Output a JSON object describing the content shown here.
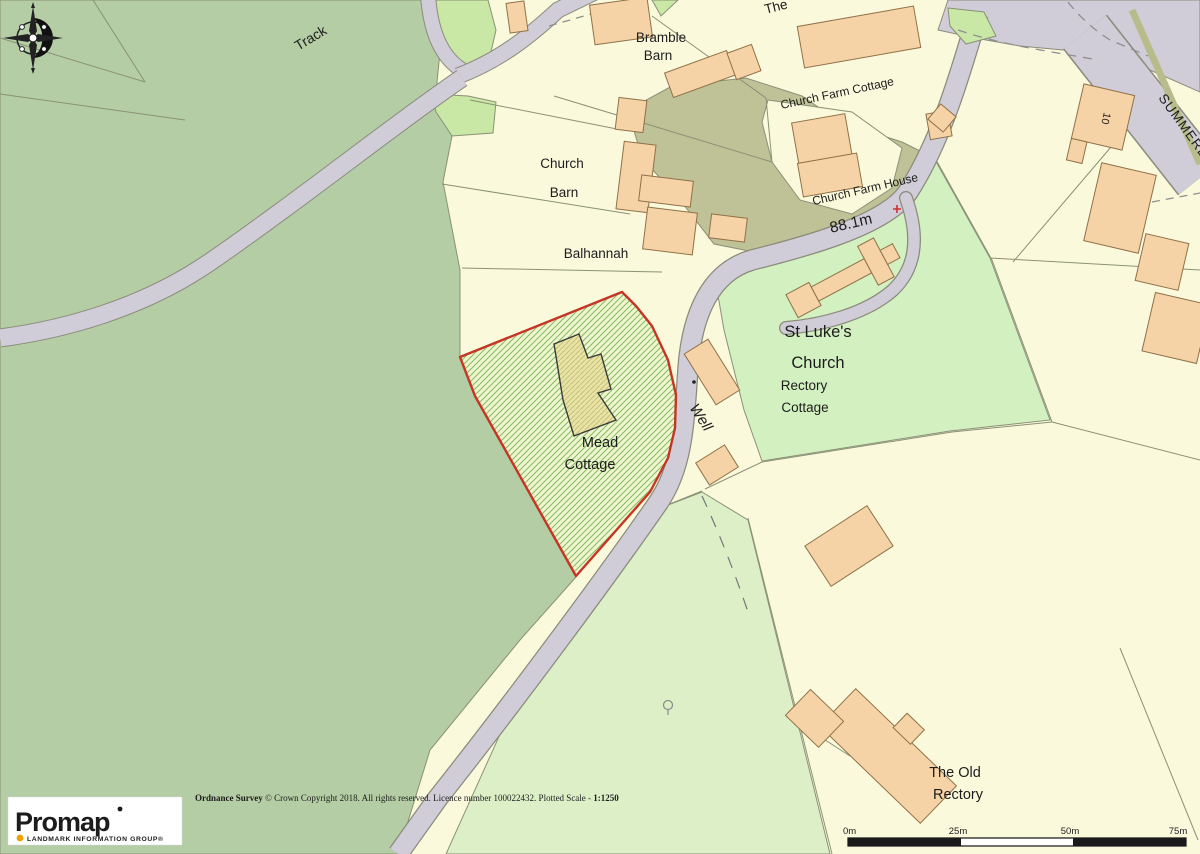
{
  "map": {
    "labels": {
      "track": "Track",
      "bramble_barn_line1": "Bramble",
      "bramble_barn_line2": "Barn",
      "the_partial": "The",
      "church_farm_cottage": "Church Farm Cottage",
      "church_barn_line1": "Church",
      "church_barn_line2": "Barn",
      "balhannah": "Balhannah",
      "church_farm_house": "Church Farm House",
      "spot_height": "88.1m",
      "st_lukes_line1": "St Luke's",
      "st_lukes_line2": "Church",
      "rectory_cottage_line1": "Rectory",
      "rectory_cottage_line2": "Cottage",
      "mead_cottage_line1": "Mead",
      "mead_cottage_line2": "Cottage",
      "well": "Well",
      "street": "SUMMERLE",
      "house_number": "10",
      "old_rectory_line1": "The Old",
      "old_rectory_line2": "Rectory"
    },
    "colors": {
      "field_green": "#b4cda4",
      "light_field_green": "#dcefc7",
      "churchyard_green": "#d3f0c0",
      "bright_verge_green": "#c9e7a5",
      "scrub_khaki": "#bfc196",
      "parcel_cream": "#fbf9dc",
      "road_grey": "#d0cdd8",
      "verge_khaki": "#b8bc8a",
      "building_peach": "#f6d3a7",
      "plot_fill": "#eef5cf",
      "plot_hatch_green": "#85bb63",
      "plot_outline_red": "#c63424",
      "well_text_blue": "#2e9bd6",
      "spot_cross_red": "#d03030",
      "logo_bullet_orange": "#f0a000"
    }
  },
  "attribution": {
    "prefix": "Ordnance Survey",
    "body": " © Crown Copyright 2018. All rights reserved. Licence number 100022432. Plotted Scale - ",
    "scale": "1:1250"
  },
  "logo": {
    "name": "Promap",
    "tagline": "LANDMARK INFORMATION GROUP®"
  },
  "scale_bar": {
    "ticks": [
      "0m",
      "25m",
      "50m",
      "75m"
    ]
  }
}
